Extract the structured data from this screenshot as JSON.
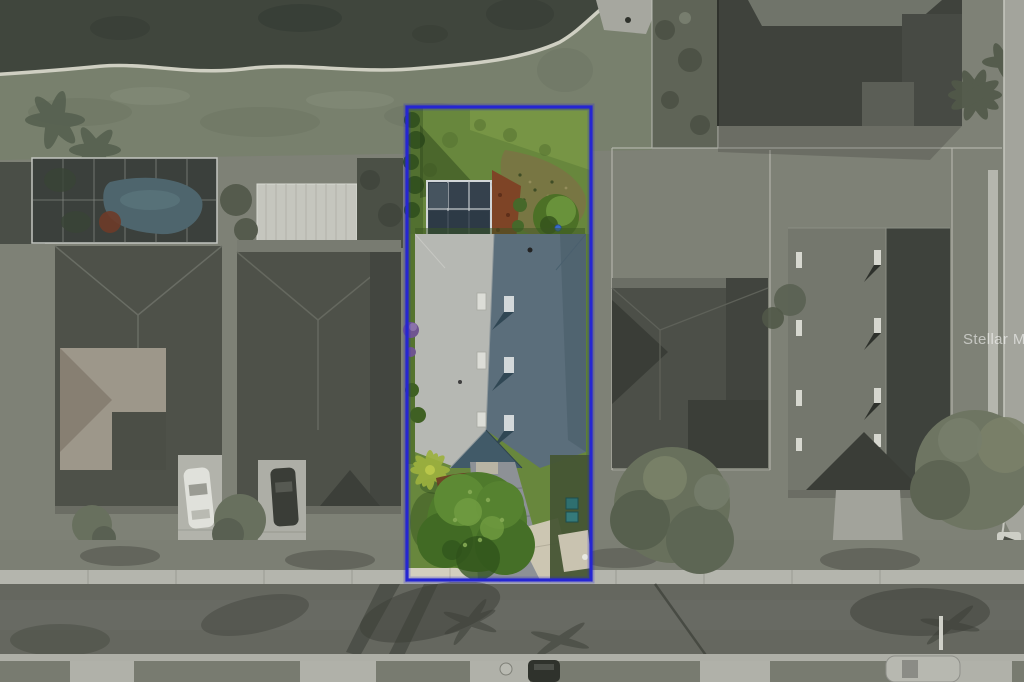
{
  "meta": {
    "description": "Aerial drone photo of a waterfront residential neighborhood; one property lot is highlighted in color inside a blue boundary rectangle while surroundings are desaturated.",
    "watermark_text": "Stellar MLS"
  },
  "watermark": {
    "text": "Stellar MLS",
    "color": "#ffffff",
    "opacity": "0.55"
  },
  "highlight": {
    "border_color": "#2525d2",
    "lawn_color": "#68873d",
    "roof_sunlit_color": "#b6b8b3",
    "roof_shaded_color": "#5b6e7b",
    "tree_color": "#4f7a2c",
    "pool_screen_color": "#35414d",
    "mulch_color": "#7e4426",
    "shrub_color": "#4c7026",
    "driveway_color": "#8d9196"
  },
  "surroundings": {
    "water_color": "#40463d",
    "shore_color": "#d7d7c9",
    "ground_color": "#7e8176",
    "road_color": "#65675f",
    "sidewalk_color": "#b4b5ad",
    "roof_dark_color": "#4e5149",
    "roof_tan_color": "#9d978a",
    "shed_color": "#c5c6be",
    "pool_water_color": "#4e656d"
  }
}
